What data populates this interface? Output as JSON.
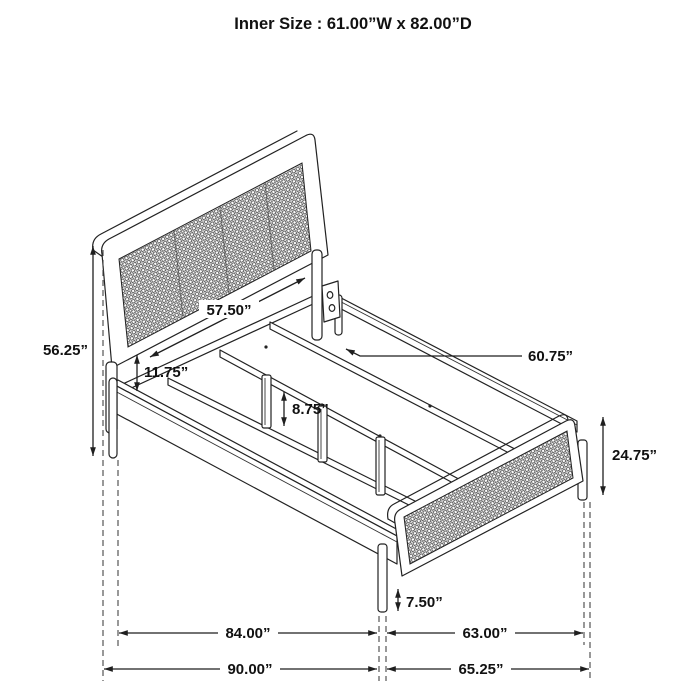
{
  "title": "Inner Size : 61.00”W x 82.00”D",
  "product": {
    "type": "bed-frame-dimension-diagram",
    "parts": [
      "cane headboard",
      "cane footboard",
      "side rails",
      "support slats",
      "support legs"
    ]
  },
  "dimensions": {
    "inner_width": "61.00”W",
    "inner_depth": "82.00”D",
    "headboard_height": "56.25”",
    "headboard_inner_width": "57.50”",
    "headboard_panel_to_rail_gap": "11.75”",
    "slat_length": "60.75”",
    "support_leg_height": "8.75”",
    "footboard_height": "24.75”",
    "footboard_ground_clearance": "7.50”",
    "rail_length": "84.00”",
    "overall_length": "90.00”",
    "footboard_inner_width": "63.00”",
    "footboard_overall_width": "65.25”"
  },
  "colors": {
    "line": "#222222",
    "background": "#ffffff",
    "cane_mesh": "#4a4a4a",
    "dimension_text": "#111111"
  }
}
